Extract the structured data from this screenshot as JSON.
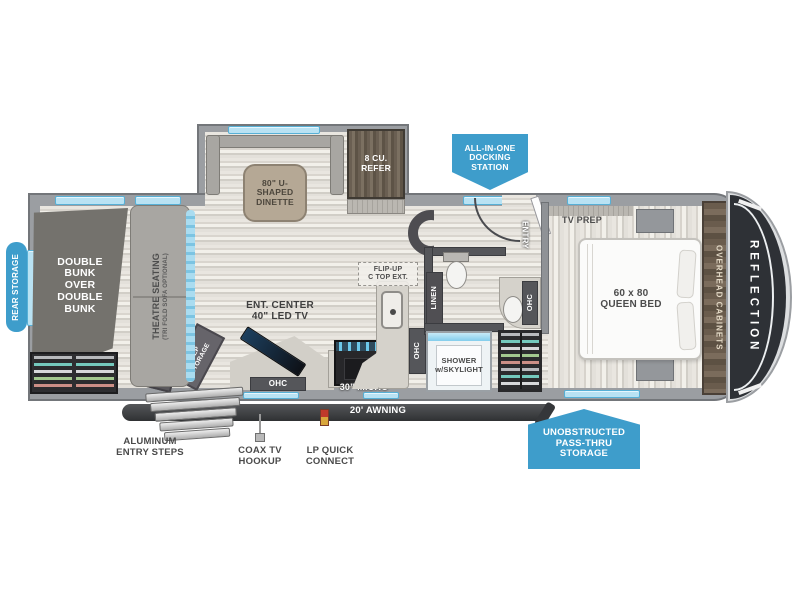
{
  "brand": "REFLECTION",
  "badges": {
    "docking": "ALL-IN-ONE\nDOCKING\nSTATION",
    "pass_thru": "UNOBSTRUCTED\nPASS-THRU\nSTORAGE",
    "rear_storage": "REAR STORAGE"
  },
  "labels": {
    "bunk": "DOUBLE\nBUNK\nOVER\nDOUBLE\nBUNK",
    "step_storage": "STEP\nSTORAGE",
    "theatre": "THEATRE SEATING",
    "theatre_sub": "(TRI FOLD SOFA OPTIONAL)",
    "dinette": "80\" U-SHAPED\nDINETTE",
    "refer": "8 CU.\nREFER",
    "entry": "ENTRY",
    "tv_prep": "TV PREP",
    "bed": "60 x 80\nQUEEN BED",
    "overhead": "OVERHEAD CABINETS",
    "flip_up": "FLIP-UP\nC TOP EXT.",
    "linen": "LINEN",
    "ohc": "OHC",
    "shower": "SHOWER\nw/SKYLIGHT",
    "ent_center": "ENT. CENTER\n40\" LED TV",
    "micro": "30\" MICRO"
  },
  "exterior": {
    "awning": "20' AWNING",
    "steps": "ALUMINUM\nENTRY STEPS",
    "coax": "COAX TV\nHOOKUP",
    "lp": "LP QUICK\nCONNECT"
  },
  "colors": {
    "badge_blue": "#3e9dcb",
    "window_blue": "#b9e2f3",
    "accent_blue": "#49b5e0",
    "wall_gray": "#9b9ea2",
    "cap_dark": "#2e3136",
    "awning_dark": "#35373a"
  }
}
